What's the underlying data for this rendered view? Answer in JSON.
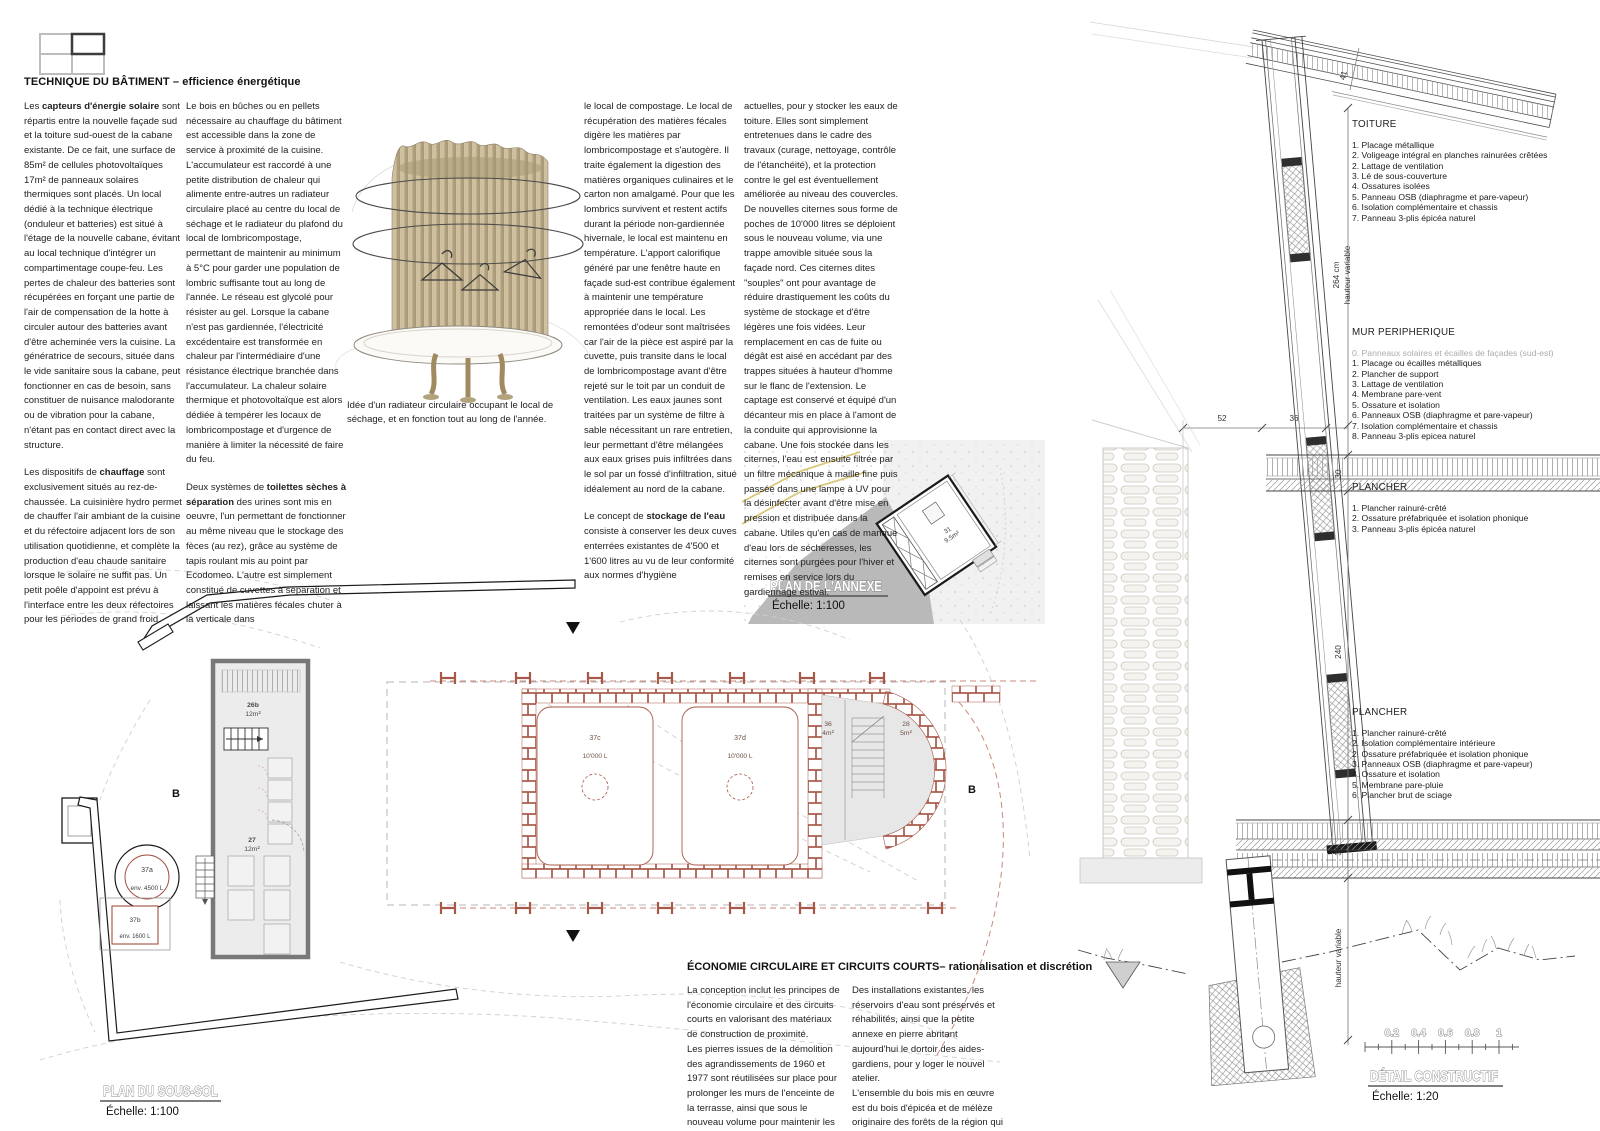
{
  "technique": {
    "title": "TECHNIQUE DU BÂTIMENT – efficience énergétique",
    "col1": {
      "p1_pre": "Les ",
      "p1_bold": "capteurs d'énergie solaire",
      "p1_post": " sont répartis entre la nouvelle façade sud et la toiture sud-ouest de la cabane existante. De ce fait, une surface de 85m² de cellules photovoltaïques 17m² de panneaux solaires thermiques sont placés. Un local dédié à la technique électrique (onduleur et batteries) est situé à l'étage de la nouvelle cabane, évitant au local technique d'intégrer un compartimentage coupe-feu. Les pertes de chaleur des batteries sont récupérées en forçant une partie de l'air de compensation de la hotte à circuler autour des batteries avant d'être acheminée vers la cuisine. La génératrice de secours, située dans le vide sanitaire sous la cabane, peut fonctionner en cas de besoin, sans constituer de nuisance malodorante ou de vibration pour la cabane, n'étant pas en contact direct avec la structure.",
      "p2_pre": "Les dispositifs de ",
      "p2_bold": "chauffage",
      "p2_post": " sont exclusivement situés au rez-de-chaussée. La cuisinière hydro permet de chauffer l'air ambiant de la cuisine et du réfectoire adjacent lors de son utilisation quotidienne, et complète la production d'eau chaude sanitaire lorsque le solaire ne suffit pas. Un petit poêle d'appoint est prévu à l'interface entre les deux réfectoires pour les périodes de grand froid."
    },
    "col2": {
      "p1": "Le bois en bûches ou en pellets nécessaire au chauffage du bâtiment est accessible dans la zone de service à proximité de la cuisine. L'accumulateur est raccordé à une petite distribution de chaleur qui alimente entre-autres un radiateur circulaire placé au centre du local de séchage et le radiateur du plafond du local de lombricompostage, permettant de maintenir au minimum à 5°C pour garder une population de lombric suffisante tout au long de l'année. Le réseau est glycolé pour résister au gel. Lorsque la cabane n'est pas gardiennée, l'électricité excédentaire est transformée en chaleur par l'intermédiaire d'une résistance électrique branchée dans l'accumulateur.  La chaleur solaire thermique et photovoltaïque est alors dédiée à tempérer les locaux de lombricompostage et d'urgence de manière à limiter la nécessité de faire du feu.",
      "p2_pre": "Deux systèmes de ",
      "p2_bold": "toilettes sèches à séparation",
      "p2_post": " des urines sont mis en oeuvre, l'un permettant de fonctionner au même niveau que le stockage des fèces (au rez), grâce au système de tapis roulant mis au point par Ecodomeo. L'autre est simplement constitué de cuvettes à séparation et laissant les matières fécales chuter à la verticale dans"
    },
    "col3": {
      "p1": "le local de compostage. Le local de récupération des matières fécales digère les matières par lombricompostage et s'autogère. Il traite également la digestion des matières organiques culinaires et le carton non amalgamé. Pour que les lombrics survivent et restent actifs durant la période non-gardiennée hivernale, le local est maintenu en température. L'apport calorifique généré par une fenêtre haute en façade sud-est contribue également à maintenir une température appropriée dans le local. Les remontées d'odeur sont maîtrisées car l'air de la pièce est aspiré par la cuvette, puis transite dans le local de lombricompostage avant d'être rejeté sur le toit par un conduit de ventilation. Les eaux jaunes sont traitées par un système de filtre à sable nécessitant un rare entretien, leur permettant d'être mélangées aux eaux grises puis infiltrées dans le sol par un fossé d'infiltration, situé idéalement au nord de la cabane.",
      "p2_pre": "Le concept de ",
      "p2_bold": "stockage de l'eau",
      "p2_post": " consiste à conserver les deux cuves enterrées existantes de 4'500 et 1'600 litres au vu de leur conformité aux normes d'hygiène"
    },
    "col4": {
      "p1": "actuelles, pour y stocker les eaux de toiture. Elles sont simplement entretenues dans le cadre des travaux (curage, nettoyage, contrôle de l'étanchéité), et la protection contre le gel est éventuellement améliorée au niveau des couvercles.  De nouvelles citernes sous forme de poches de 10'000 litres se déploient sous le nouveau volume, via une trappe amovible située sous la façade nord. Ces citernes dites \"souples\" ont pour avantage de réduire drastiquement les coûts du système de stockage et d'être légères une fois vidées. Leur remplacement en cas de fuite ou dégât est aisé en accédant par des trappes situées à hauteur d'homme sur le flanc de l'extension. Le captage est conservé et équipé d'un décanteur mis en place à l'amont de la conduite qui approvisionne la cabane. Une fois stockée dans les citernes, l'eau est ensuite filtrée par un filtre mécanique à maille fine puis passée dans une lampe à UV pour la désinfecter avant d'être mise en pression et distribuée dans la cabane. Utiles qu'en cas de manque d'eau lors de sécheresses, les citernes sont purgées pour l'hiver et remises en service lors du gardiennage estival."
    }
  },
  "radiator": {
    "caption": "Idée d'un radiateur circulaire occupant le local de séchage, et en fonction tout au long de l'année."
  },
  "plan_annexe": {
    "title": "PLAN DE L'ANNEXE",
    "scale": "Échelle: 1:100",
    "room_id": "31",
    "room_area": "9.5m²"
  },
  "plan_soussol": {
    "title": "PLAN DU SOUS-SOL",
    "scale": "Échelle: 1:100",
    "section_label": "B",
    "r26b_id": "26b",
    "r26b_area": "12m²",
    "r27_id": "27",
    "r27_area": "12m²",
    "r36_id": "36",
    "r36_area": "4m²",
    "r28_id": "28",
    "r28_area": "5m²",
    "t37a_id": "37a",
    "t37a_vol": "env. 4500 L",
    "t37b_id": "37b",
    "t37b_vol": "env. 1600 L",
    "t37c_id": "37c",
    "t37c_vol": "10'000 L",
    "t37d_id": "37d",
    "t37d_vol": "10'000 L"
  },
  "economie": {
    "title": "ÉCONOMIE CIRCULAIRE ET CIRCUITS COURTS– rationalisation et discrétion",
    "col1": "La conception inclut les principes de l'économie circulaire et des circuits courts en valorisant des matériaux de construction de proximité.\nLes pierres issues de la démolition des agrandissements de 1960 et 1977 sont réutilisées sur place pour prolonger les murs de l'enceinte de la terrasse, ainsi que sous le nouveau volume pour maintenir les citernes de stockage de l'eau.",
    "col2": "Des installations existantes, les réservoirs d'eau sont préservés et réhabilités, ainsi que la petite annexe en pierre abritant aujourd'hui le dortoir des aides-gardiens, pour y loger le nouvel atelier.\nL'ensemble du bois mis en œuvre est du bois d'épicéa et de mélèze originaire des forêts de la région qui sont gérées de manière durable."
  },
  "detail": {
    "title": "DÉTAIL CONSTRUCTIF",
    "scale": "Échelle: 1:20",
    "toiture": {
      "heading": "TOITURE",
      "items": [
        "1. Placage métallique",
        "2. Voligeage intégral en planches rainurées crêtées",
        "2. Lattage de ventilation",
        "3. Lé de sous-couverture",
        "4. Ossatures isolées",
        "5. Panneau OSB (diaphragme et pare-vapeur)",
        "6. Isolation complémentaire et chassis",
        "7. Panneau 3-plis épicéa naturel"
      ]
    },
    "mur": {
      "heading": "MUR PERIPHERIQUE",
      "item0": "0. Panneaux solaires et écailles de façades (sud-est)",
      "items": [
        "1. Placage ou écailles métalliques",
        "2. Plancher de support",
        "3. Lattage de ventilation",
        "4. Membrane pare-vent",
        "5. Ossature et isolation",
        "6. Panneaux OSB (diaphragme et pare-vapeur)",
        "7. Isolation complémentaire et chassis",
        "8. Panneau 3-plis epicea naturel"
      ]
    },
    "plancher1": {
      "heading": "PLANCHER",
      "items": [
        "1. Plancher rainuré-crêté",
        "2. Ossature préfabriquée et isolation phonique",
        "3. Panneau 3-plis épicéa naturel"
      ]
    },
    "plancher2": {
      "heading": "PLANCHER",
      "items": [
        "1. Plancher rainuré-crêté",
        "2. Isolation complémentaire intérieure",
        "2. Ossature préfabriquée et isolation phonique",
        "3. Panneaux OSB (diaphragme et pare-vapeur)",
        "4. Ossature et isolation",
        "5. Membrane pare-pluie",
        "6. Plancher brut de sciage"
      ]
    },
    "dims": {
      "d41": "41",
      "d264": "264 cm",
      "d264b": "hauteur variable",
      "d52": "52",
      "d36a": "36",
      "d30": "30",
      "d240": "240",
      "d36b": "36",
      "dhv": "hauteur variable"
    },
    "scalebar": [
      "0.2",
      "0.4",
      "0.6",
      "0.8",
      "1"
    ]
  }
}
